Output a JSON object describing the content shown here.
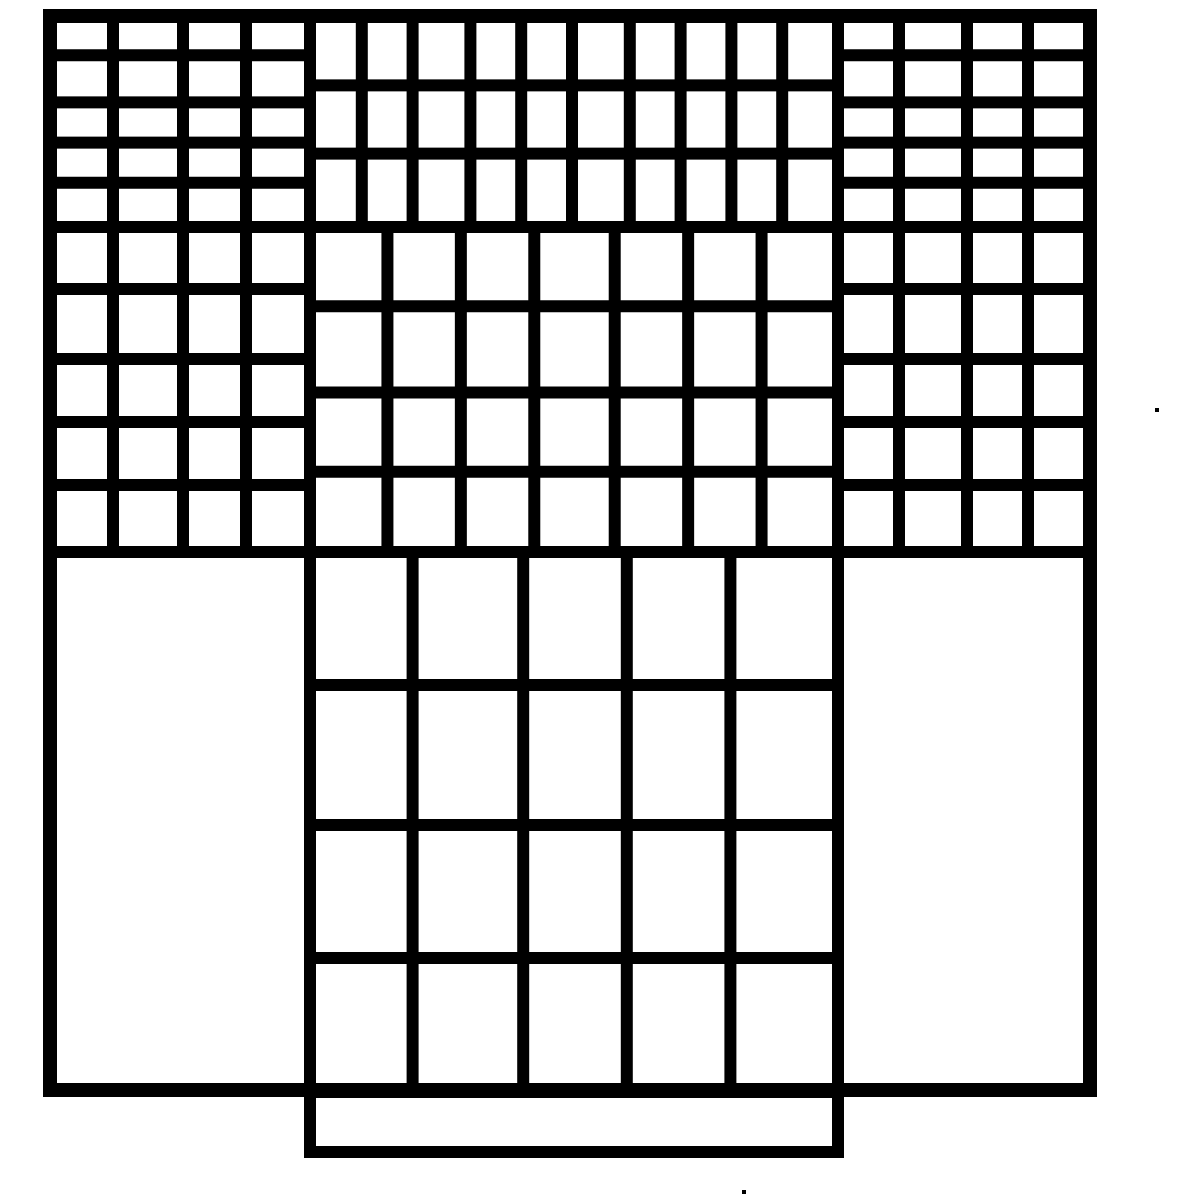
{
  "figure": {
    "canvas": {
      "width": 1200,
      "height": 1200
    },
    "background_color": "#ffffff",
    "ink_color": "#000000",
    "inner_stroke_width": 12,
    "outer_stroke_width": 14,
    "outer_border": {
      "x0": 50,
      "y0": 16,
      "x1": 1090,
      "y1": 1090
    },
    "sections": [
      {
        "name": "top-left-fine-grid",
        "x0": 50,
        "y0": 16,
        "x1": 310,
        "y1": 227,
        "cols": 4,
        "rows": 5
      },
      {
        "name": "middle-left-grid",
        "x0": 50,
        "y0": 227,
        "x1": 310,
        "y1": 552,
        "cols": 4,
        "rows": 5
      },
      {
        "name": "top-center-grid",
        "x0": 310,
        "y0": 16,
        "x1": 838,
        "y1": 227,
        "cols": 10,
        "rows": 3
      },
      {
        "name": "middle-center-grid",
        "x0": 310,
        "y0": 227,
        "x1": 838,
        "y1": 552,
        "cols": 7,
        "rows": 4
      },
      {
        "name": "top-right-fine-grid",
        "x0": 838,
        "y0": 16,
        "x1": 1090,
        "y1": 227,
        "cols": 4,
        "rows": 5
      },
      {
        "name": "middle-right-grid",
        "x0": 838,
        "y0": 227,
        "x1": 1090,
        "y1": 552,
        "cols": 4,
        "rows": 5
      },
      {
        "name": "bottom-center-coarse-grid",
        "x0": 310,
        "y0": 552,
        "x1": 838,
        "y1": 1092,
        "cols": 5,
        "rows": 4
      },
      {
        "name": "bottom-protruding-tab",
        "x0": 310,
        "y0": 1092,
        "x1": 838,
        "y1": 1152,
        "cols": 1,
        "rows": 1
      },
      {
        "name": "bottom-left-blank-panel",
        "x0": 50,
        "y0": 552,
        "x1": 310,
        "y1": 1090,
        "cols": 1,
        "rows": 1
      },
      {
        "name": "bottom-right-blank-panel",
        "x0": 838,
        "y0": 552,
        "x1": 1090,
        "y1": 1090,
        "cols": 1,
        "rows": 1
      }
    ],
    "specks": [
      {
        "x": 1155,
        "y": 408
      },
      {
        "x": 742,
        "y": 1190
      }
    ]
  }
}
